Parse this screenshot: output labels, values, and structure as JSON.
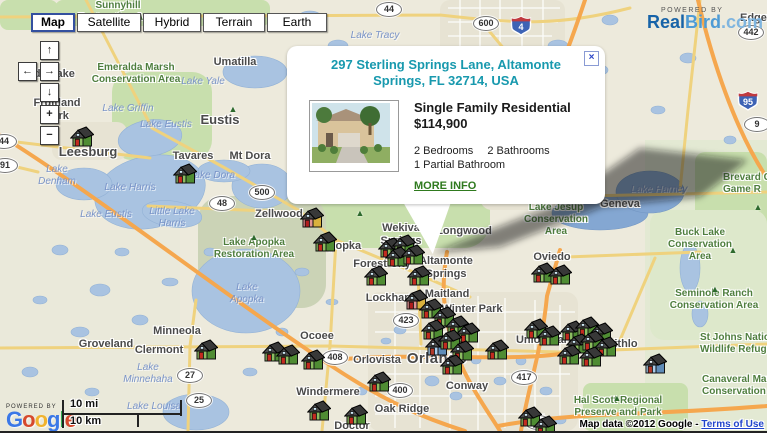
{
  "map_controls": {
    "buttons": [
      {
        "label": "Map",
        "selected": true
      },
      {
        "label": "Satellite",
        "selected": false
      },
      {
        "label": "Hybrid",
        "selected": false
      },
      {
        "label": "Terrain",
        "selected": false
      },
      {
        "label": "Earth",
        "selected": false
      }
    ]
  },
  "pan_zoom": {
    "up": "↑",
    "left": "←",
    "right": "→",
    "down": "↓",
    "zoom_in": "+",
    "zoom_out": "−"
  },
  "branding_realbird": {
    "powered_by": "POWERED BY",
    "real": "Real",
    "bird": "Bird",
    "dotcom": ".com",
    "real_color": "#1763A8",
    "bird_color": "#4E9BD5",
    "dotcom_color": "#7FB5DF"
  },
  "branding_google": {
    "powered_by": "POWERED BY",
    "letters": [
      {
        "ch": "G",
        "c": "#3b78e7"
      },
      {
        "ch": "o",
        "c": "#d6492c"
      },
      {
        "ch": "o",
        "c": "#f0b32f"
      },
      {
        "ch": "g",
        "c": "#3b78e7"
      },
      {
        "ch": "l",
        "c": "#30a94f"
      },
      {
        "ch": "e",
        "c": "#d6492c"
      }
    ]
  },
  "scale_bar": {
    "miles": "10 mi",
    "kilometers": "10 km"
  },
  "attribution": {
    "text": "Map data ©2012 Google - ",
    "link": "Terms of Use"
  },
  "popup": {
    "address": "297 Sterling Springs Lane, Altamonte Springs, FL 32714, USA",
    "property_type": "Single Family Residential",
    "price": "$114,900",
    "bedrooms": "2 Bedrooms",
    "bathrooms": "2 Bathrooms",
    "partial_bathroom": "1 Partial Bathroom",
    "more_info": "MORE INFO",
    "close_icon": "×"
  },
  "marker_styles": {
    "g": {
      "front": "#8CBE62",
      "side": "#4F8C33",
      "door": "#C42B20",
      "win": "#CFE9F6"
    },
    "r": {
      "front": "#E09191",
      "side": "#D9B13E",
      "door": "#B01D1D",
      "win": "#CFE9F6"
    },
    "b": {
      "front": "#A9CDEC",
      "side": "#5F8CB8",
      "door": "#B23A2A",
      "win": "#E8F4FB"
    }
  },
  "markers": [
    {
      "x": 82,
      "y": 138,
      "v": "g"
    },
    {
      "x": 185,
      "y": 175,
      "v": "g"
    },
    {
      "x": 312,
      "y": 219,
      "v": "r"
    },
    {
      "x": 325,
      "y": 243,
      "v": "g"
    },
    {
      "x": 390,
      "y": 249,
      "v": "g"
    },
    {
      "x": 404,
      "y": 246,
      "v": "g"
    },
    {
      "x": 397,
      "y": 258,
      "v": "g"
    },
    {
      "x": 413,
      "y": 256,
      "v": "g"
    },
    {
      "x": 376,
      "y": 277,
      "v": "g"
    },
    {
      "x": 419,
      "y": 277,
      "v": "g"
    },
    {
      "x": 416,
      "y": 301,
      "v": "r"
    },
    {
      "x": 431,
      "y": 310,
      "v": "g"
    },
    {
      "x": 444,
      "y": 318,
      "v": "g"
    },
    {
      "x": 457,
      "y": 327,
      "v": "g"
    },
    {
      "x": 468,
      "y": 334,
      "v": "g"
    },
    {
      "x": 433,
      "y": 331,
      "v": "g"
    },
    {
      "x": 437,
      "y": 347,
      "v": "b"
    },
    {
      "x": 450,
      "y": 341,
      "v": "g"
    },
    {
      "x": 462,
      "y": 352,
      "v": "g"
    },
    {
      "x": 452,
      "y": 366,
      "v": "g"
    },
    {
      "x": 497,
      "y": 351,
      "v": "g"
    },
    {
      "x": 536,
      "y": 330,
      "v": "g"
    },
    {
      "x": 549,
      "y": 337,
      "v": "g"
    },
    {
      "x": 543,
      "y": 274,
      "v": "g"
    },
    {
      "x": 560,
      "y": 276,
      "v": "g"
    },
    {
      "x": 206,
      "y": 351,
      "v": "g"
    },
    {
      "x": 274,
      "y": 353,
      "v": "g"
    },
    {
      "x": 288,
      "y": 356,
      "v": "g"
    },
    {
      "x": 313,
      "y": 361,
      "v": "g"
    },
    {
      "x": 319,
      "y": 412,
      "v": "g"
    },
    {
      "x": 356,
      "y": 416,
      "v": "g"
    },
    {
      "x": 379,
      "y": 383,
      "v": "g"
    },
    {
      "x": 530,
      "y": 418,
      "v": "g"
    },
    {
      "x": 545,
      "y": 427,
      "v": "g"
    },
    {
      "x": 572,
      "y": 332,
      "v": "g"
    },
    {
      "x": 587,
      "y": 328,
      "v": "g"
    },
    {
      "x": 601,
      "y": 334,
      "v": "g"
    },
    {
      "x": 578,
      "y": 345,
      "v": "g"
    },
    {
      "x": 592,
      "y": 342,
      "v": "g"
    },
    {
      "x": 606,
      "y": 348,
      "v": "g"
    },
    {
      "x": 569,
      "y": 356,
      "v": "g"
    },
    {
      "x": 591,
      "y": 358,
      "v": "g"
    },
    {
      "x": 655,
      "y": 365,
      "v": "b"
    }
  ],
  "labels": {
    "cities": [
      {
        "t": "Lady Lake",
        "x": 48,
        "y": 68
      },
      {
        "t": "Fruitland\nPark",
        "x": 57,
        "y": 97
      },
      {
        "t": "Umatilla",
        "x": 235,
        "y": 56
      },
      {
        "t": "Eustis",
        "x": 220,
        "y": 112,
        "s": "lg"
      },
      {
        "t": "Leesburg",
        "x": 88,
        "y": 144,
        "s": "lg"
      },
      {
        "t": "Tavares",
        "x": 193,
        "y": 150
      },
      {
        "t": "Mt Dora",
        "x": 250,
        "y": 150
      },
      {
        "t": "Zellwood",
        "x": 279,
        "y": 208
      },
      {
        "t": "Apopka",
        "x": 341,
        "y": 240
      },
      {
        "t": "Wekiva\nSprings",
        "x": 401,
        "y": 222
      },
      {
        "t": "Longwood",
        "x": 464,
        "y": 225
      },
      {
        "t": "Forest City",
        "x": 382,
        "y": 258
      },
      {
        "t": "Altamonte\nSprings",
        "x": 446,
        "y": 255
      },
      {
        "t": "Maitland",
        "x": 447,
        "y": 288
      },
      {
        "t": "Lockhart",
        "x": 389,
        "y": 292
      },
      {
        "t": "Winter Park",
        "x": 472,
        "y": 303
      },
      {
        "t": "Oviedo",
        "x": 552,
        "y": 251
      },
      {
        "t": "Geneva",
        "x": 620,
        "y": 198
      },
      {
        "t": "Ocoee",
        "x": 317,
        "y": 330
      },
      {
        "t": "Orlovista",
        "x": 377,
        "y": 354
      },
      {
        "t": "Orlando",
        "x": 437,
        "y": 350,
        "s": "xl"
      },
      {
        "t": "Conway",
        "x": 467,
        "y": 380
      },
      {
        "t": "Oak Ridge",
        "x": 402,
        "y": 403
      },
      {
        "t": "Union Park",
        "x": 545,
        "y": 334
      },
      {
        "t": "Windermere",
        "x": 328,
        "y": 386
      },
      {
        "t": "Minneola",
        "x": 177,
        "y": 325
      },
      {
        "t": "Clermont",
        "x": 159,
        "y": 344
      },
      {
        "t": "Groveland",
        "x": 106,
        "y": 338
      },
      {
        "t": "Bithlo",
        "x": 622,
        "y": 338
      },
      {
        "t": "Edgewater",
        "x": 740,
        "y": 12,
        "left": 740
      },
      {
        "t": "Doctor\nPhillips",
        "x": 352,
        "y": 420
      }
    ],
    "water": [
      {
        "t": "Lake Tracy",
        "x": 375,
        "y": 30
      },
      {
        "t": "Lake Yale",
        "x": 203,
        "y": 76
      },
      {
        "t": "Lake Griffin",
        "x": 128,
        "y": 103
      },
      {
        "t": "Lake\nDenham",
        "x": 57,
        "y": 164
      },
      {
        "t": "Lake Harris",
        "x": 130,
        "y": 182
      },
      {
        "t": "Lake Eustis",
        "x": 166,
        "y": 119
      },
      {
        "t": "Lake Eustis",
        "x": 106,
        "y": 209
      },
      {
        "t": "Little Lake\nHarris",
        "x": 172,
        "y": 206
      },
      {
        "t": "Lake Dora",
        "x": 212,
        "y": 170
      },
      {
        "t": "Lake\nApopka",
        "x": 247,
        "y": 282
      },
      {
        "t": "Lake Harney",
        "x": 659,
        "y": 184
      },
      {
        "t": "Lake Louisa",
        "x": 154,
        "y": 401
      },
      {
        "t": "Lake\nMinnehaha",
        "x": 148,
        "y": 362
      }
    ],
    "parks": [
      {
        "t": "Sunnyhill\nRestoration Area",
        "x": 118,
        "y": 0
      },
      {
        "t": "Emeralda Marsh\nConservation Area",
        "x": 136,
        "y": 62
      },
      {
        "t": "Lake Apopka\nRestoration Area",
        "x": 254,
        "y": 237
      },
      {
        "t": "Lake Jesup\nConservation\nArea",
        "x": 556,
        "y": 202
      },
      {
        "t": "Buck Lake\nConservation\nArea",
        "x": 700,
        "y": 227
      },
      {
        "t": "Seminole Ranch\nConservation Area",
        "x": 714,
        "y": 288
      },
      {
        "t": "St Johns Nationa\nWildlife Refuge",
        "x": 700,
        "y": 332,
        "left": 700
      },
      {
        "t": "Canaveral Marsh\nConservation Are",
        "x": 702,
        "y": 374,
        "left": 702
      },
      {
        "t": "Brevard C\nGame R",
        "x": 723,
        "y": 172,
        "left": 723
      },
      {
        "t": "Hal Scott Regional\nPreserve and Park",
        "x": 618,
        "y": 395
      }
    ]
  },
  "shields": [
    {
      "n": "44",
      "x": 389,
      "y": 2
    },
    {
      "n": "44",
      "x": 4,
      "y": 134
    },
    {
      "n": "91",
      "x": 5,
      "y": 158
    },
    {
      "n": "600",
      "x": 486,
      "y": 16
    },
    {
      "n": "442",
      "x": 751,
      "y": 25
    },
    {
      "n": "9",
      "x": 757,
      "y": 117
    },
    {
      "n": "48",
      "x": 222,
      "y": 196
    },
    {
      "n": "500",
      "x": 262,
      "y": 185
    },
    {
      "n": "423",
      "x": 406,
      "y": 313
    },
    {
      "n": "408",
      "x": 335,
      "y": 350
    },
    {
      "n": "400",
      "x": 400,
      "y": 383
    },
    {
      "n": "417",
      "x": 524,
      "y": 370
    },
    {
      "n": "27",
      "x": 190,
      "y": 368
    },
    {
      "n": "25",
      "x": 199,
      "y": 393
    },
    {
      "n": "528",
      "x": 538,
      "y": 415
    }
  ],
  "interstates": [
    {
      "n": "4",
      "x": 521,
      "y": 15
    },
    {
      "n": "95",
      "x": 748,
      "y": 90
    }
  ],
  "trees": [
    {
      "x": 233,
      "y": 104
    },
    {
      "x": 254,
      "y": 232
    },
    {
      "x": 360,
      "y": 208
    },
    {
      "x": 733,
      "y": 245
    },
    {
      "x": 715,
      "y": 284
    },
    {
      "x": 617,
      "y": 393
    },
    {
      "x": 758,
      "y": 202
    }
  ]
}
